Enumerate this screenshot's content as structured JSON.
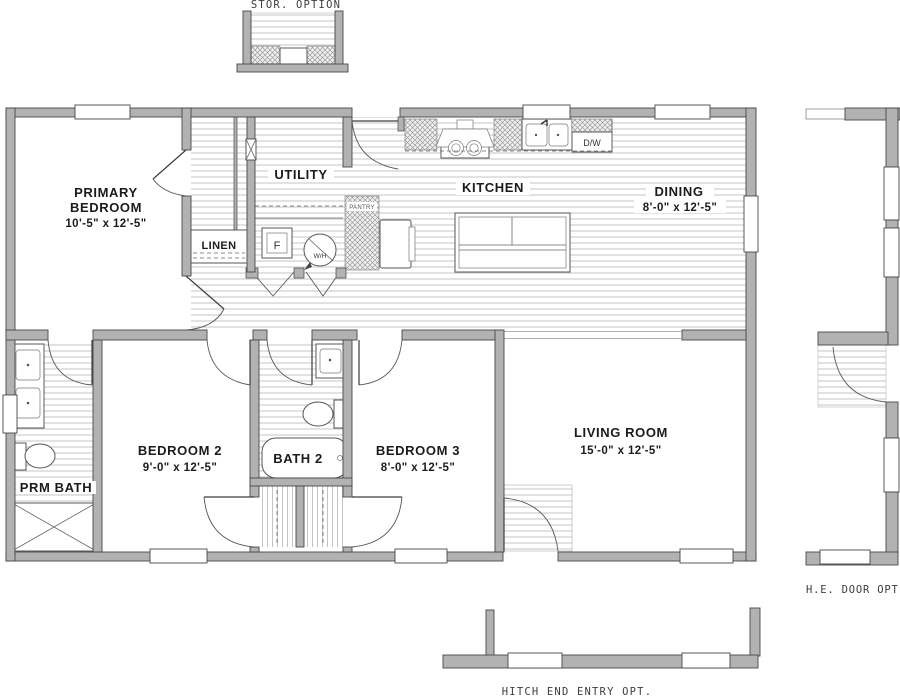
{
  "title": "Floor plan",
  "colors": {
    "wall_fill": "#b2b2b2",
    "wall_stroke": "#474747",
    "floor_stripe": "#c6c6c6",
    "room_text": "#1b1b1b",
    "cad_text": "#3d3d3d"
  },
  "rooms": {
    "primary": {
      "line1": "PRIMARY",
      "line2": "BEDROOM",
      "dims": "10'-5\" x  12'-5\""
    },
    "utility": {
      "name": "UTILITY"
    },
    "kitchen": {
      "name": "KITCHEN"
    },
    "dining": {
      "name": "DINING",
      "dims": "8'-0\" x  12'-5\""
    },
    "linen": {
      "name": "LINEN"
    },
    "bedroom2": {
      "name": "BEDROOM 2",
      "dims": "9'-0\" x  12'-5\""
    },
    "bath2": {
      "name": "BATH 2"
    },
    "bedroom3": {
      "name": "BEDROOM 3",
      "dims": "8'-0\" x  12'-5\""
    },
    "living": {
      "name": "LIVING ROOM",
      "dims": "15'-0\" x  12'-5\""
    },
    "prm_bath": {
      "name": "PRM BATH"
    },
    "pantry": {
      "name": "PANTRY"
    }
  },
  "appliances": {
    "furnace": "F",
    "water_heater": "W/H",
    "dishwasher": "D/W"
  },
  "options": {
    "storage": "STOR.  OPTION",
    "he_door": "H.E.  DOOR  OPT.",
    "hitch_end": "HITCH  END  ENTRY  OPT."
  }
}
